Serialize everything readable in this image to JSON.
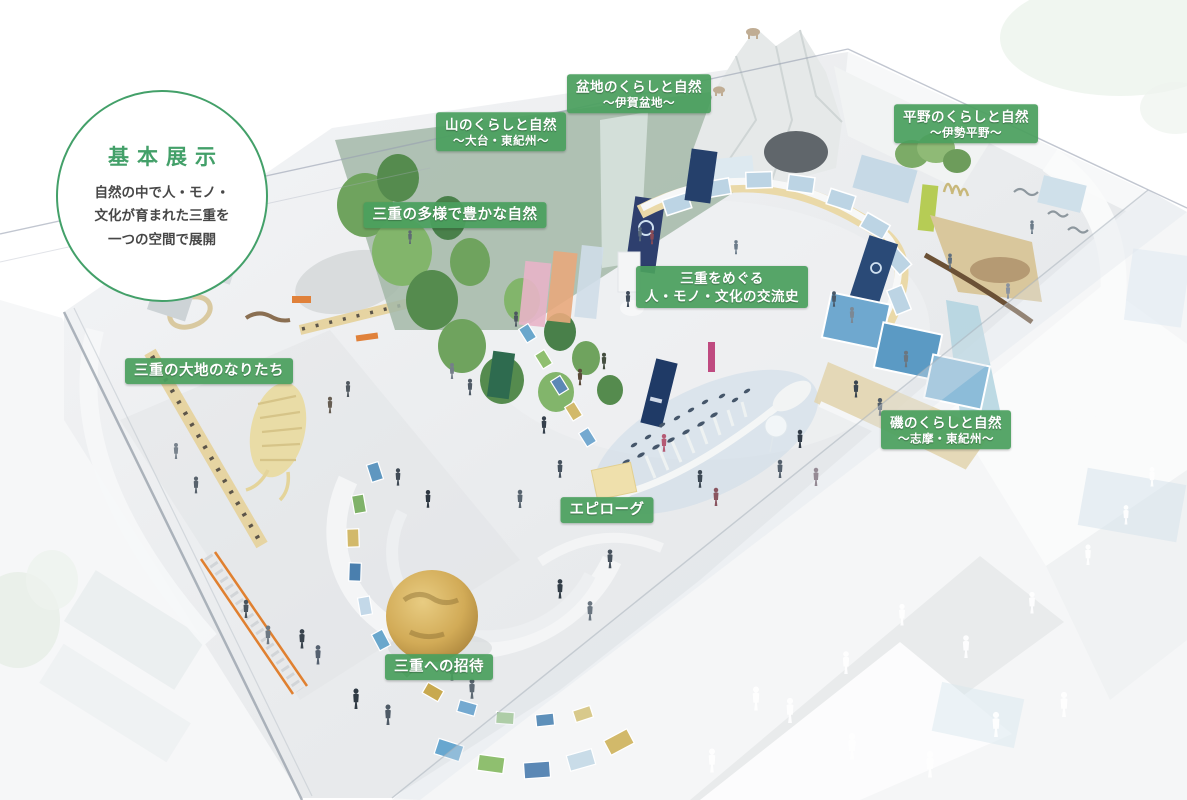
{
  "badge": {
    "title": "基本展示",
    "desc_line1": "自然の中で人・モノ・",
    "desc_line2": "文化が育まれた三重を",
    "desc_line3": "一つの空間で展開"
  },
  "labels": {
    "yama": {
      "line1": "山のくらしと自然",
      "line2": "～大台・東紀州～"
    },
    "bonchi": {
      "line1": "盆地のくらしと自然",
      "line2": "～伊賀盆地～"
    },
    "heiya": {
      "line1": "平野のくらしと自然",
      "line2": "～伊勢平野～"
    },
    "tayou": {
      "line1": "三重の多様で豊かな自然"
    },
    "kouryuu": {
      "line1": "三重をめぐる",
      "line2": "人・モノ・文化の交流史"
    },
    "daichi": {
      "line1": "三重の大地のなりたち"
    },
    "iso": {
      "line1": "磯のくらしと自然",
      "line2": "～志摩・東紀州～"
    },
    "epilogue": {
      "line1": "エピローグ"
    },
    "shoutai": {
      "line1": "三重への招待"
    }
  },
  "colors": {
    "label_green": "#4a9f5e",
    "badge_green": "#43a069",
    "body_text": "#474747",
    "floor_gray": "#e9ebed",
    "forest_green": "#6fa35e",
    "counter_beige": "#e6d5a2",
    "exhibit_blue": "#bcd4e4",
    "globe_gold": "#d9b460"
  }
}
